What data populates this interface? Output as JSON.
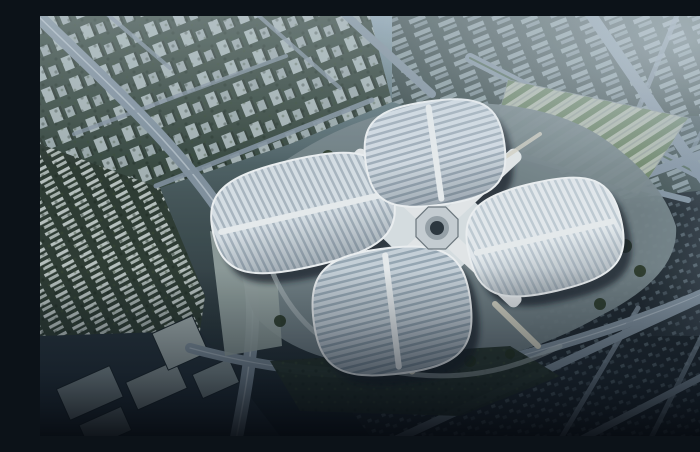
{
  "scene": {
    "title": "Aerial rendering of a four-petal clover-shaped exhibition complex in a hazy city",
    "description": "Bird's-eye architectural rendering: four striped petal-shaped roofs arranged around a central octagonal hub with white X-shaped connectors, surrounded by a gray plaza, a tree-lined parking field to the northeast, diagonal boulevards, rows of housing towers, industrial boxes and dark city blocks fading into blue haze at the top and darkness at the bottom."
  },
  "palette": {
    "sky_top": "#8fa6b3",
    "mid_upper": "#647b81",
    "mid": "#47585a",
    "lower": "#303d41",
    "bottom": "#161f26",
    "road": "#8494a1",
    "road_light": "#cfd9e0",
    "median_green": "#3e5a3c",
    "district_towers": "#394a41",
    "district_slabs": "#40504f",
    "district_arcs": "#2e3b32",
    "district_industrial": "#26323a",
    "district_blocks": "#20292f",
    "district_park": "#27342b",
    "tower_face": "#bcc9cc",
    "tower_face2": "#aebbbf",
    "tower_shadow": "#2c3832",
    "slab_face": "#9fb0b6",
    "slab_face2": "#8a9ba2",
    "bar_face": "#ccd5d2",
    "bar_face2": "#b9c4bf",
    "dot_face": "#5b6a72",
    "dot_face2": "#49575f",
    "box_face": "#8e9b9d",
    "plaza": "#77868a",
    "plaza_west": "#9aa7a4",
    "parking_base": "#b2bcab",
    "parking_trees": "#5f7a55",
    "tree": "#24331f",
    "petal_north_base": "#d8e1e8",
    "petal_north_stripe": "#a6b4bf",
    "petal_west_base": "#dde5ea",
    "petal_west_stripe": "#aebbc5",
    "petal_east_base": "#eaf0f3",
    "petal_east_stripe": "#c6d1d9",
    "petal_south_base": "#ccd6de",
    "petal_south_stripe": "#9aabb7",
    "petal_rim": "#f3f6f7",
    "petal_spine": "#eef2f3",
    "podium": "#dde4e6",
    "arm": "#e9edee",
    "arm_edge": "#39444b",
    "hub_ring": "#ccd3d7",
    "hub_mid": "#9aa5ab",
    "hub_core": "#2c363e",
    "shadow": "#131d26",
    "corridor": "#d9d6c6",
    "apron": "#b8c3c4"
  },
  "building": {
    "name": "clover-exhibition-center",
    "petals": [
      {
        "id": "north"
      },
      {
        "id": "west"
      },
      {
        "id": "east"
      },
      {
        "id": "south"
      }
    ],
    "hub": "central-octagon-hub",
    "connectors": [
      "nw-arm",
      "ne-arm",
      "sw-arm",
      "se-arm",
      "sw-walkway",
      "se-walkway",
      "ne-link"
    ]
  },
  "city": {
    "districts": [
      "tower-rows-northwest",
      "slab-blocks-northeast",
      "arc-housing-west",
      "industrial-boxes-southwest",
      "dark-blocks-southeast",
      "park-south",
      "tree-lined-parking-northeast"
    ],
    "roads": [
      "northwest-boulevard",
      "northeast-avenue",
      "east-diagonal-road",
      "south-ring-road",
      "southeast-avenues"
    ]
  }
}
